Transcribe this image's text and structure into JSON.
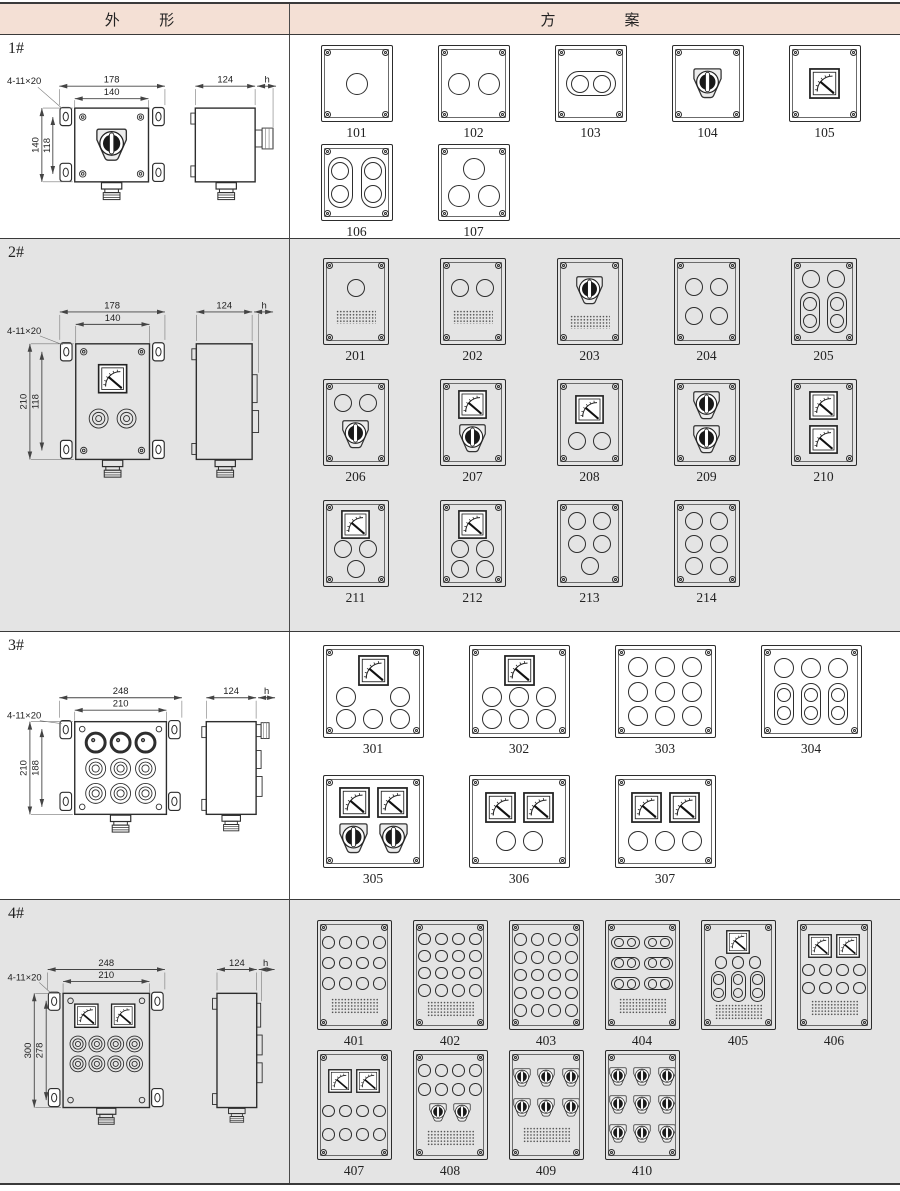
{
  "page": {
    "colors": {
      "header_bg": "#f4e0d5",
      "row_alt_bg": "#e4e4e4",
      "table_line": "#3a3a3a",
      "drawing_line": "#2e2e2e"
    }
  },
  "header": {
    "left": "外  形",
    "right": "方    案"
  },
  "rows": [
    {
      "label": "1#",
      "drawing": {
        "callout": "4-11×20",
        "top_outer": "178",
        "top_inner": "140",
        "left_outer": "140",
        "left_inner": "118",
        "side_width": "124",
        "side_h": "h"
      },
      "schemes": [
        {
          "id": "101",
          "rows": [
            [
              "c"
            ]
          ]
        },
        {
          "id": "102",
          "rows": [
            [
              "c",
              "c"
            ]
          ]
        },
        {
          "id": "103",
          "rows": [
            [
              "sh"
            ]
          ]
        },
        {
          "id": "104",
          "rows": [
            [
              "sw"
            ]
          ]
        },
        {
          "id": "105",
          "rows": [
            [
              "m"
            ]
          ]
        },
        {
          "id": "106",
          "rows": [
            [
              "sv",
              "sv"
            ]
          ]
        },
        {
          "id": "107",
          "rows": [
            [
              "c"
            ],
            [
              "c",
              "c"
            ]
          ]
        }
      ]
    },
    {
      "label": "2#",
      "drawing": {
        "callout": "4-11×20",
        "top_outer": "178",
        "top_inner": "140",
        "left_outer": "210",
        "left_inner": "118",
        "side_width": "124",
        "side_h": "h"
      },
      "schemes": [
        {
          "id": "201",
          "rows": [
            [
              "c"
            ],
            [
              "pl"
            ]
          ]
        },
        {
          "id": "202",
          "rows": [
            [
              "c",
              "c"
            ],
            [
              "pl"
            ]
          ]
        },
        {
          "id": "203",
          "rows": [
            [
              "sw"
            ],
            [
              "pl"
            ]
          ]
        },
        {
          "id": "204",
          "rows": [
            [
              "c",
              "c"
            ],
            [
              "c",
              "c"
            ]
          ]
        },
        {
          "id": "205",
          "rows": [
            [
              "c",
              "c"
            ],
            [
              "sv",
              "sv"
            ]
          ]
        },
        {
          "id": "206",
          "rows": [
            [
              "c",
              "c"
            ],
            [
              "sw"
            ]
          ]
        },
        {
          "id": "207",
          "rows": [
            [
              "m"
            ],
            [
              "sw"
            ]
          ]
        },
        {
          "id": "208",
          "rows": [
            [
              "m"
            ],
            [
              "c",
              "c"
            ]
          ]
        },
        {
          "id": "209",
          "rows": [
            [
              "sw"
            ],
            [
              "sw"
            ]
          ]
        },
        {
          "id": "210",
          "rows": [
            [
              "m"
            ],
            [
              "m"
            ]
          ]
        },
        {
          "id": "211",
          "rows": [
            [
              "m"
            ],
            [
              "c",
              "c"
            ],
            [
              "c"
            ]
          ]
        },
        {
          "id": "212",
          "rows": [
            [
              "m"
            ],
            [
              "c",
              "c"
            ],
            [
              "c",
              "c"
            ]
          ]
        },
        {
          "id": "213",
          "rows": [
            [
              "c",
              "c"
            ],
            [
              "c",
              "c"
            ],
            [
              "c"
            ]
          ]
        },
        {
          "id": "214",
          "rows": [
            [
              "c",
              "c"
            ],
            [
              "c",
              "c"
            ],
            [
              "c",
              "c"
            ]
          ]
        }
      ]
    },
    {
      "label": "3#",
      "drawing": {
        "callout": "4-11×20",
        "top_outer": "248",
        "top_inner": "210",
        "left_outer": "210",
        "left_inner": "188",
        "side_width": "124",
        "side_h": "h"
      },
      "schemes": [
        {
          "id": "301",
          "rows": [
            [
              "m"
            ],
            [
              "c",
              "sp",
              "c"
            ],
            [
              "c",
              "c",
              "c"
            ]
          ]
        },
        {
          "id": "302",
          "rows": [
            [
              "m"
            ],
            [
              "c",
              "c",
              "c"
            ],
            [
              "c",
              "c",
              "c"
            ]
          ]
        },
        {
          "id": "303",
          "rows": [
            [
              "c",
              "c",
              "c"
            ],
            [
              "c",
              "c",
              "c"
            ],
            [
              "c",
              "c",
              "c"
            ]
          ]
        },
        {
          "id": "304",
          "rows": [
            [
              "c",
              "c",
              "c"
            ],
            [
              "sv",
              "sv",
              "sv"
            ]
          ]
        },
        {
          "id": "305",
          "rows": [
            [
              "m",
              "m"
            ],
            [
              "sw",
              "sw"
            ]
          ]
        },
        {
          "id": "306",
          "rows": [
            [
              "m",
              "m"
            ],
            [
              "c",
              "c"
            ]
          ]
        },
        {
          "id": "307",
          "rows": [
            [
              "m",
              "m"
            ],
            [
              "c",
              "c",
              "c"
            ]
          ]
        }
      ]
    },
    {
      "label": "4#",
      "drawing": {
        "callout": "4-11×20",
        "top_outer": "248",
        "top_inner": "210",
        "left_outer": "300",
        "left_inner": "278",
        "side_width": "124",
        "side_h": "h"
      },
      "schemes": [
        {
          "id": "401",
          "rows": [
            [
              "c",
              "c",
              "c",
              "c"
            ],
            [
              "c",
              "c",
              "c",
              "c"
            ],
            [
              "c",
              "c",
              "c",
              "c"
            ],
            [
              "pl"
            ]
          ]
        },
        {
          "id": "402",
          "rows": [
            [
              "c",
              "c",
              "c",
              "c"
            ],
            [
              "c",
              "c",
              "c",
              "c"
            ],
            [
              "c",
              "c",
              "c",
              "c"
            ],
            [
              "c",
              "c",
              "c",
              "c"
            ],
            [
              "pl"
            ]
          ]
        },
        {
          "id": "403",
          "rows": [
            [
              "c",
              "c",
              "c",
              "c"
            ],
            [
              "c",
              "c",
              "c",
              "c"
            ],
            [
              "c",
              "c",
              "c",
              "c"
            ],
            [
              "c",
              "c",
              "c",
              "c"
            ],
            [
              "c",
              "c",
              "c",
              "c"
            ]
          ]
        },
        {
          "id": "404",
          "rows": [
            [
              "sh",
              "sh"
            ],
            [
              "sh",
              "sh"
            ],
            [
              "sh",
              "sh"
            ],
            [
              "pl"
            ]
          ]
        },
        {
          "id": "405",
          "rows": [
            [
              "m"
            ],
            [
              "c",
              "c",
              "c"
            ],
            [
              "sv",
              "sv",
              "sv"
            ],
            [
              "pl"
            ]
          ]
        },
        {
          "id": "406",
          "rows": [
            [
              "m",
              "m"
            ],
            [
              "c",
              "c",
              "c",
              "c"
            ],
            [
              "c",
              "c",
              "c",
              "c"
            ],
            [
              "pl"
            ]
          ]
        },
        {
          "id": "407",
          "rows": [
            [
              "m",
              "m"
            ],
            [
              "c",
              "c",
              "c",
              "c"
            ],
            [
              "c",
              "c",
              "c",
              "c"
            ]
          ]
        },
        {
          "id": "408",
          "rows": [
            [
              "c",
              "c",
              "c",
              "c"
            ],
            [
              "c",
              "c",
              "c",
              "c"
            ],
            [
              "sw",
              "sw"
            ],
            [
              "pl"
            ]
          ]
        },
        {
          "id": "409",
          "rows": [
            [
              "sw",
              "sw",
              "sw"
            ],
            [
              "sw",
              "sw",
              "sw"
            ],
            [
              "pl"
            ]
          ]
        },
        {
          "id": "410",
          "rows": [
            [
              "sw",
              "sw",
              "sw"
            ],
            [
              "sw",
              "sw",
              "sw"
            ],
            [
              "sw",
              "sw",
              "sw"
            ]
          ]
        }
      ]
    }
  ]
}
